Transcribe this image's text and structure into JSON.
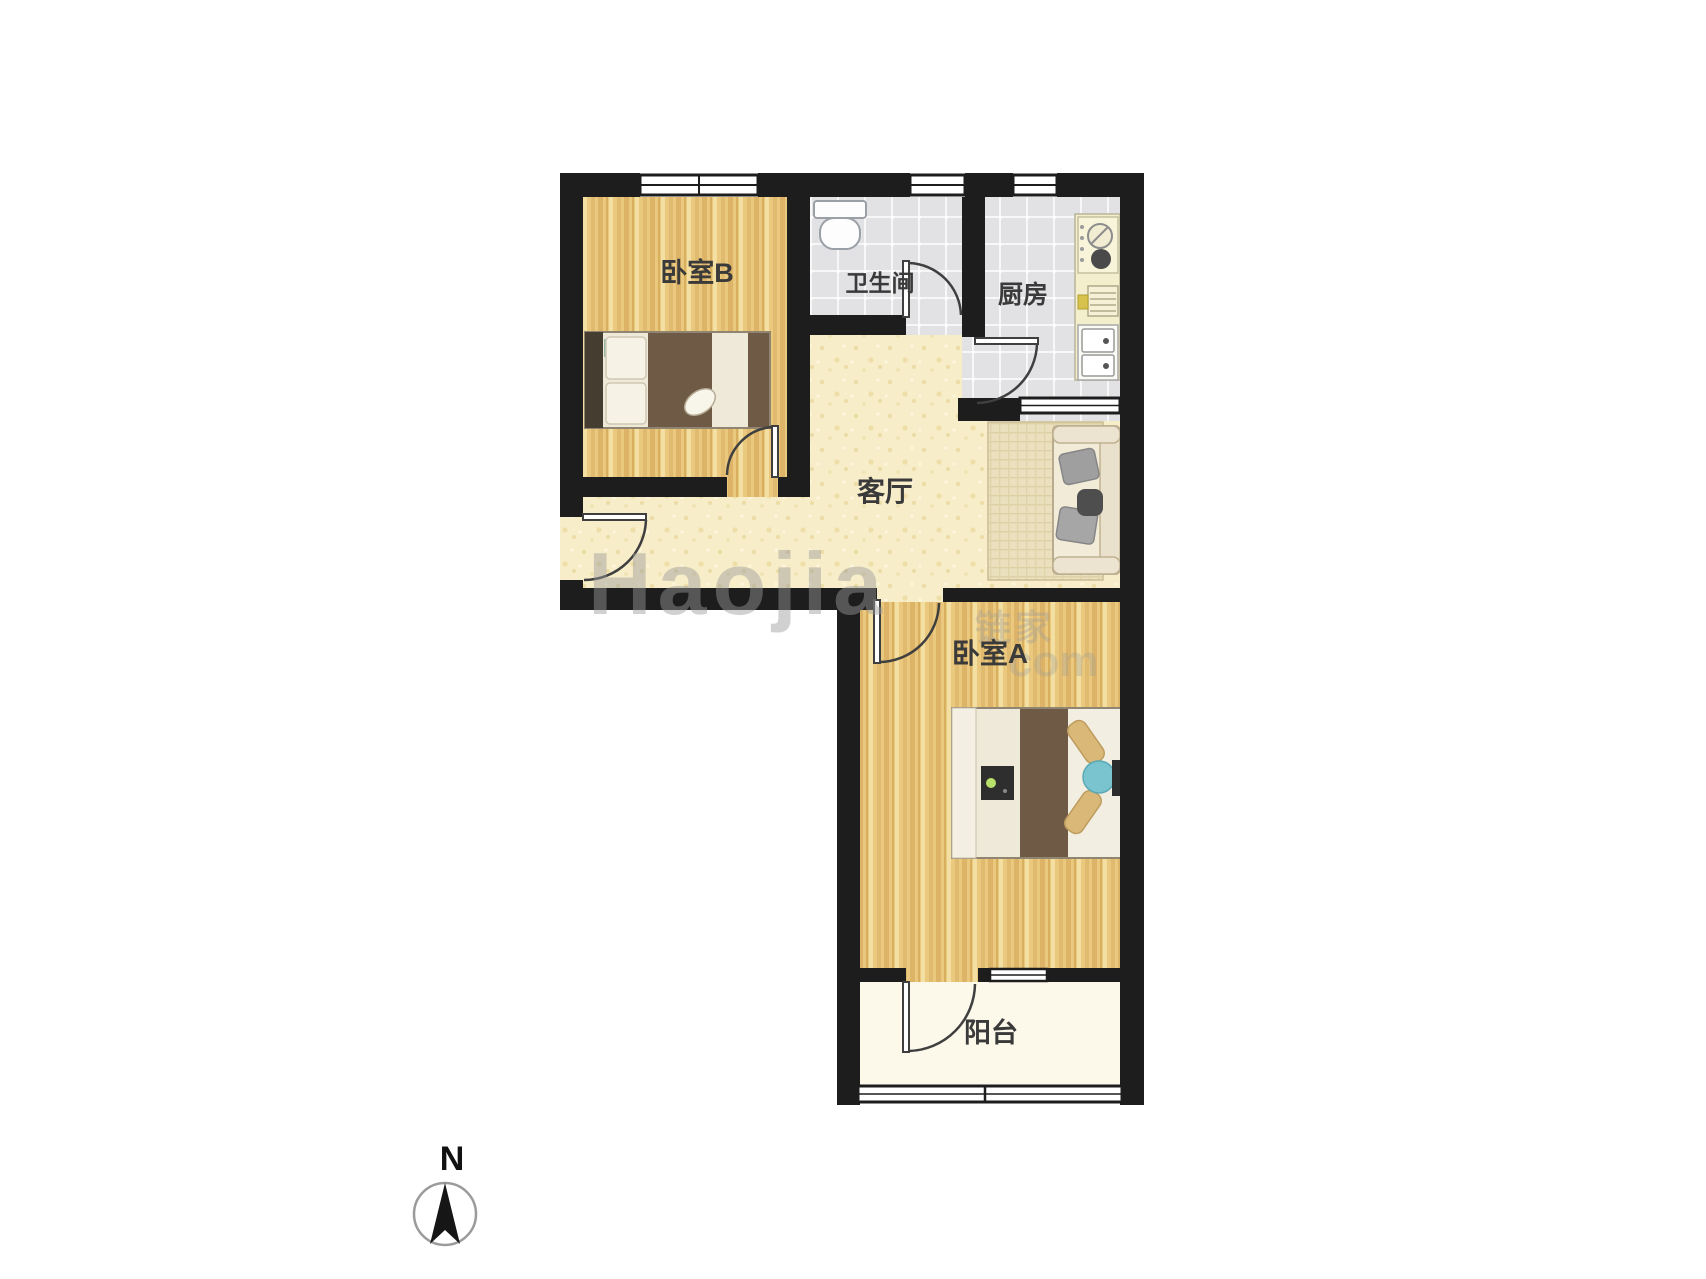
{
  "rooms": {
    "bedroom_b": {
      "label": "卧室B"
    },
    "bathroom": {
      "label": "卫生间"
    },
    "kitchen": {
      "label": "厨房"
    },
    "living_room": {
      "label": "客厅"
    },
    "bedroom_a": {
      "label": "卧室A"
    },
    "balcony": {
      "label": "阳台"
    }
  },
  "compass": {
    "north_label": "N"
  },
  "watermark": {
    "latin": "Haojia",
    "cjk": "链家",
    "tail": "com"
  },
  "colors": {
    "wall": "#1d1d1d",
    "wood_floor": "#eac87e",
    "living_floor": "#f7edc8",
    "tile_floor": "#e2e2e5",
    "balcony_floor": "#fcf8ea",
    "duvet_brown": "#6f5b45",
    "accent_teal": "#79c4cf",
    "background": "#ffffff"
  }
}
